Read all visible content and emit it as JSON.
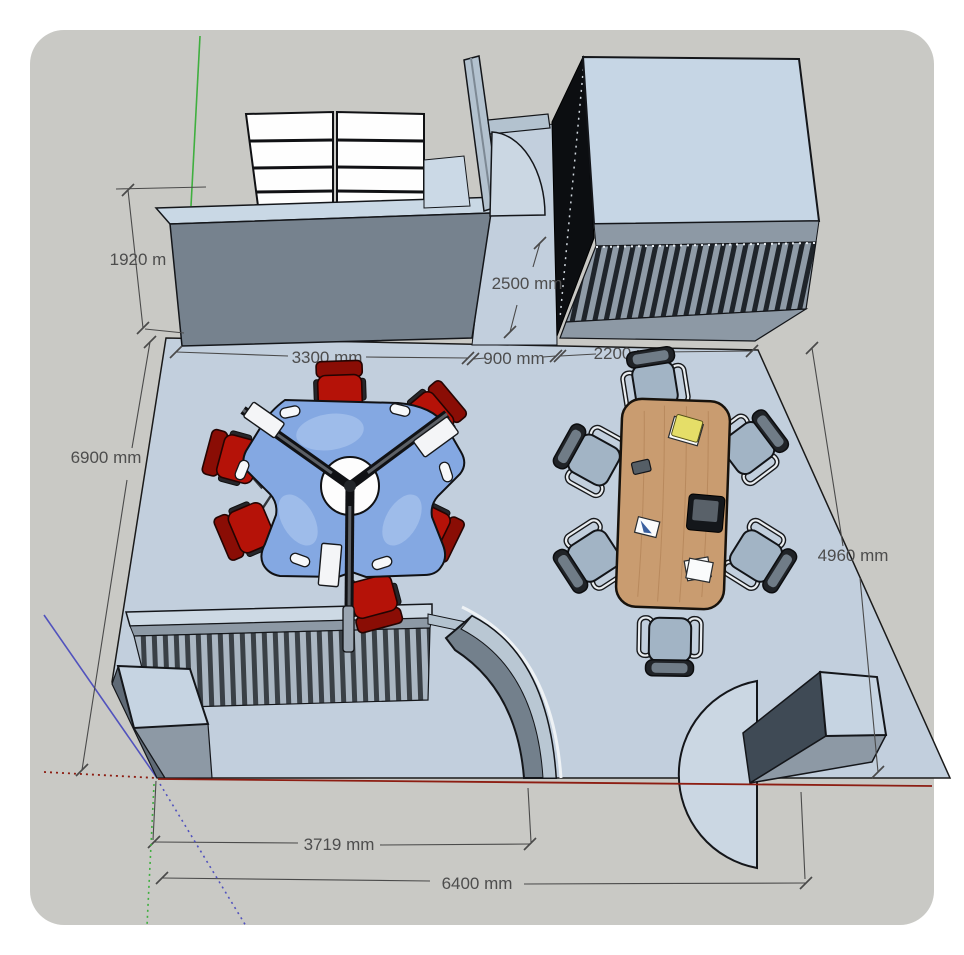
{
  "dimensions": [
    {
      "id": "left-wall-height",
      "label": "1920 m"
    },
    {
      "id": "door-wall",
      "label": "2500 mm"
    },
    {
      "id": "top-left-span",
      "label": "3300 mm"
    },
    {
      "id": "doorway-width",
      "label": "900 mm"
    },
    {
      "id": "top-right-span",
      "label": "2200 mm"
    },
    {
      "id": "room-depth-left",
      "label": "6900 mm"
    },
    {
      "id": "room-depth-right",
      "label": "4960 mm"
    },
    {
      "id": "bottom-inner-span",
      "label": "3719 mm"
    },
    {
      "id": "room-width",
      "label": "6400 mm"
    }
  ],
  "axes": {
    "green": "#3faf3f",
    "red": "#8d1d12",
    "blue": "#5152bd"
  },
  "colors": {
    "surface": "#c9c9c5",
    "floor": "#c2cfdd",
    "floor_light": "#cbd7e3",
    "wall_top": "#c9d8e5",
    "wall_face": "#76828e",
    "desk": "#84a8e2",
    "desk_chair_red": "#b51208",
    "conference_chair": "#a2b4c5",
    "table_wood": "#c99c70",
    "cabinet_top": "#c6d6e5",
    "shelf_white": "#fefefe",
    "dimension_text": "#4d4d4d"
  }
}
